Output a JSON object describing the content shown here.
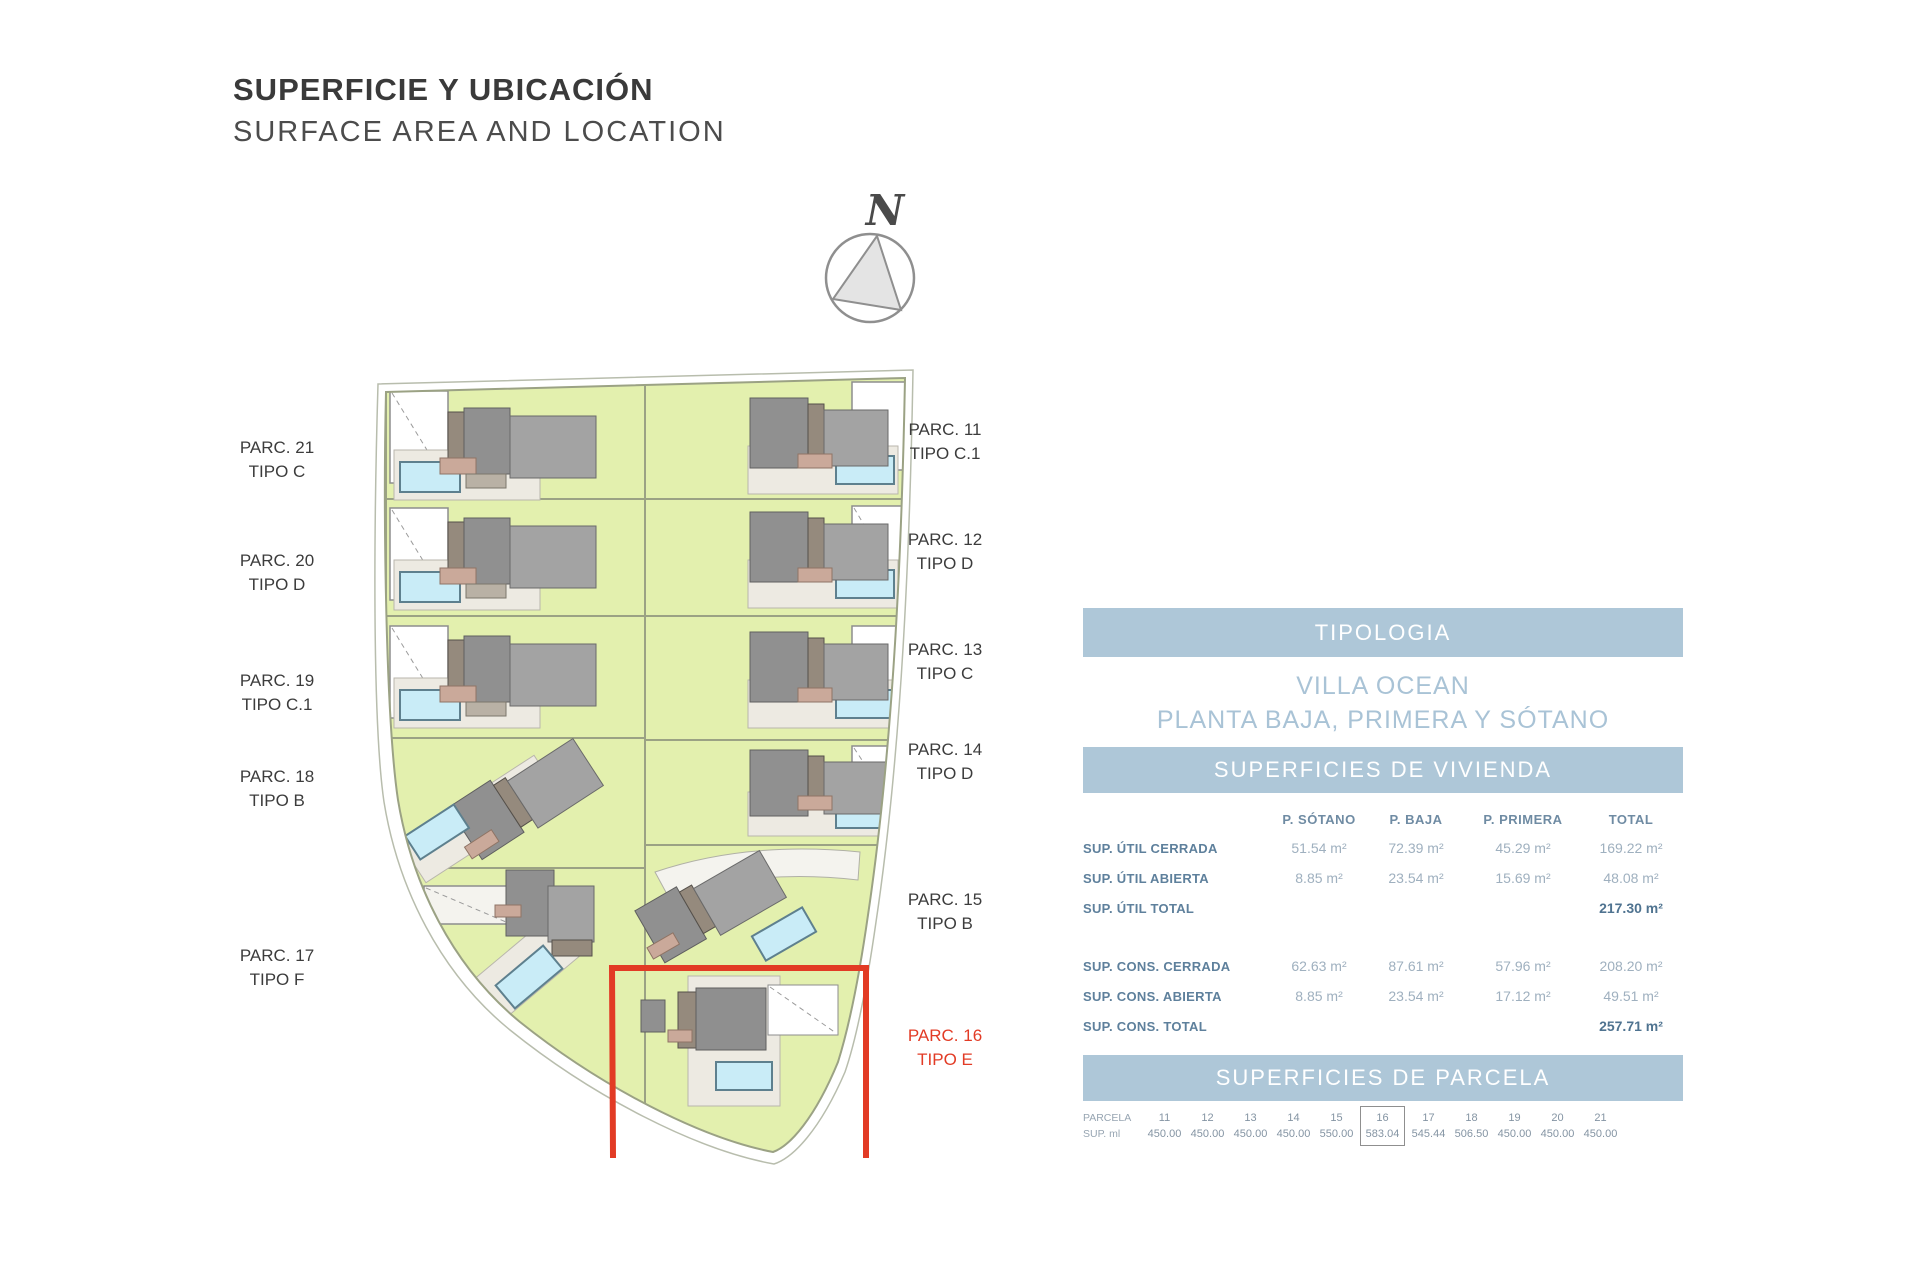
{
  "header": {
    "title_es": "SUPERFICIE Y UBICACIÓN",
    "title_en": "SURFACE AREA AND LOCATION"
  },
  "compass": {
    "north_label": "N"
  },
  "plan": {
    "labels_left": [
      {
        "parc": "PARC. 21",
        "tipo": "TIPO C"
      },
      {
        "parc": "PARC. 20",
        "tipo": "TIPO D"
      },
      {
        "parc": "PARC. 19",
        "tipo": "TIPO C.1"
      },
      {
        "parc": "PARC. 18",
        "tipo": "TIPO B"
      },
      {
        "parc": "PARC. 17",
        "tipo": "TIPO F"
      }
    ],
    "labels_right": [
      {
        "parc": "PARC. 11",
        "tipo": "TIPO C.1"
      },
      {
        "parc": "PARC. 12",
        "tipo": "TIPO D"
      },
      {
        "parc": "PARC. 13",
        "tipo": "TIPO C"
      },
      {
        "parc": "PARC. 14",
        "tipo": "TIPO D"
      },
      {
        "parc": "PARC. 15",
        "tipo": "TIPO B"
      },
      {
        "parc": "PARC. 16",
        "tipo": "TIPO E"
      }
    ],
    "highlighted_parcel": "PARC. 16",
    "colors": {
      "highlight_red": "#e23b25",
      "garden_green": "#e3f0ae",
      "pool_blue": "#c9ecf7",
      "building_gray": "#909090",
      "band_blue": "#aec7d8"
    }
  },
  "typology": {
    "band": "TIPOLOGIA",
    "line1": "VILLA OCEAN",
    "line2": "PLANTA BAJA, PRIMERA Y SÓTANO"
  },
  "dwelling": {
    "band": "SUPERFICIES DE VIVIENDA",
    "columns": [
      "P. SÓTANO",
      "P. BAJA",
      "P. PRIMERA",
      "TOTAL"
    ],
    "rows": [
      {
        "label": "SUP. ÚTIL CERRADA",
        "sotano": "51.54 m²",
        "baja": "72.39 m²",
        "primera": "45.29 m²",
        "total": "169.22 m²"
      },
      {
        "label": "SUP. ÚTIL ABIERTA",
        "sotano": "8.85 m²",
        "baja": "23.54 m²",
        "primera": "15.69 m²",
        "total": "48.08 m²"
      },
      {
        "label": "SUP. ÚTIL TOTAL",
        "sotano": "",
        "baja": "",
        "primera": "",
        "total": "217.30 m²"
      },
      {
        "label": "SUP. CONS. CERRADA",
        "sotano": "62.63 m²",
        "baja": "87.61 m²",
        "primera": "57.96 m²",
        "total": "208.20 m²"
      },
      {
        "label": "SUP. CONS. ABIERTA",
        "sotano": "8.85 m²",
        "baja": "23.54 m²",
        "primera": "17.12 m²",
        "total": "49.51 m²"
      },
      {
        "label": "SUP. CONS. TOTAL",
        "sotano": "",
        "baja": "",
        "primera": "",
        "total": "257.71 m²"
      }
    ]
  },
  "plot": {
    "band": "SUPERFICIES DE PARCELA",
    "row_label_top": "PARCELA",
    "row_label_bottom": "SUP. ml",
    "columns": [
      {
        "parcela": "11",
        "sup": "450.00"
      },
      {
        "parcela": "12",
        "sup": "450.00"
      },
      {
        "parcela": "13",
        "sup": "450.00"
      },
      {
        "parcela": "14",
        "sup": "450.00"
      },
      {
        "parcela": "15",
        "sup": "550.00"
      },
      {
        "parcela": "16",
        "sup": "583.04"
      },
      {
        "parcela": "17",
        "sup": "545.44"
      },
      {
        "parcela": "18",
        "sup": "506.50"
      },
      {
        "parcela": "19",
        "sup": "450.00"
      },
      {
        "parcela": "20",
        "sup": "450.00"
      },
      {
        "parcela": "21",
        "sup": "450.00"
      }
    ]
  }
}
